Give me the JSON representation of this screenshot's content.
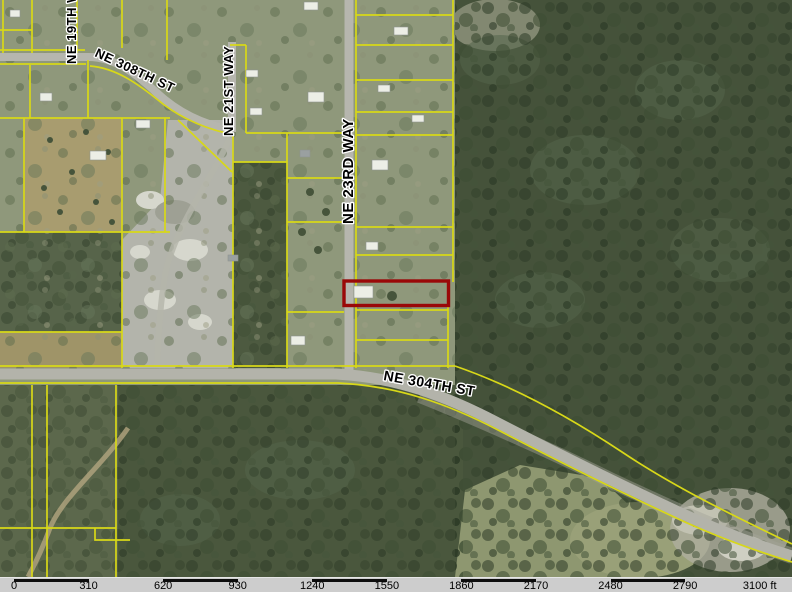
{
  "map": {
    "type": "aerial-parcel-map",
    "streets": [
      {
        "id": "ne-19th-way",
        "label": "NE 19TH WAY",
        "orientation": "vertical"
      },
      {
        "id": "ne-308th-st",
        "label": "NE 308TH ST",
        "orientation": "diagonal"
      },
      {
        "id": "ne-21st-way",
        "label": "NE 21ST WAY",
        "orientation": "vertical"
      },
      {
        "id": "ne-23rd-way",
        "label": "NE 23RD WAY",
        "orientation": "vertical"
      },
      {
        "id": "ne-304th-st",
        "label": "NE 304TH ST",
        "orientation": "horizontal"
      }
    ],
    "highlighted_parcel": {
      "description": "subject parcel outlined in red, east side of NE 23RD WAY north of NE 304TH ST"
    },
    "colors": {
      "parcel_line": "#d8d818",
      "highlight": "#9a0808",
      "road": "#b6b6ae",
      "forest": "#45523a",
      "scalebar_bg": "#cdcdcd"
    }
  },
  "scale_bar": {
    "labels": [
      "0",
      "310",
      "620",
      "930",
      "1240",
      "1550",
      "1860",
      "2170",
      "2480",
      "2790"
    ],
    "end_label": "3100 ft",
    "unit": "ft",
    "first_tick_x": 14,
    "tick_spacing_px": 74.57
  }
}
